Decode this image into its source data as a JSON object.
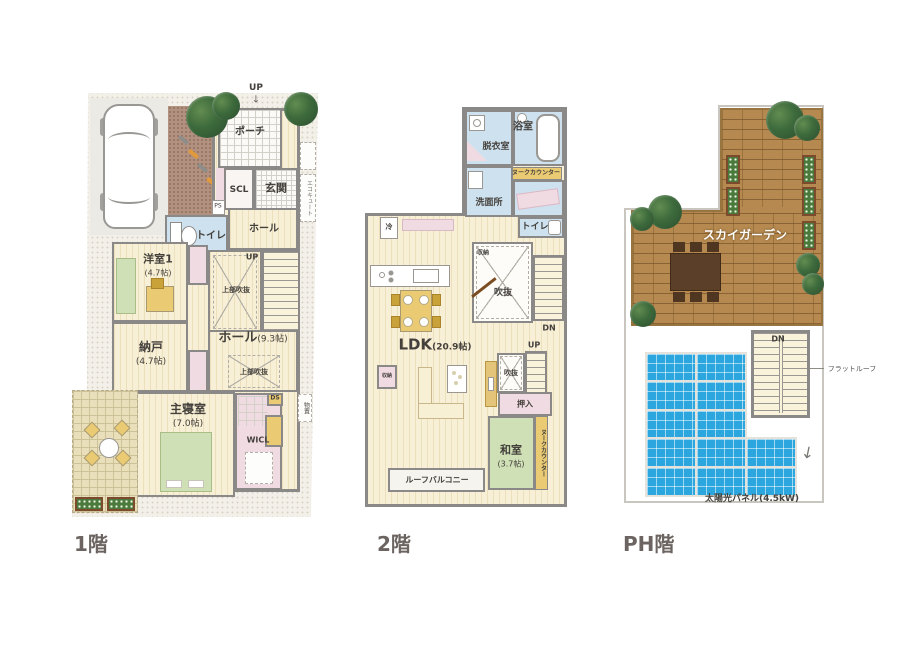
{
  "colors": {
    "wall": "#8b8987",
    "wood_floor": "#f8f0d6",
    "water_blue": "#cde1ee",
    "closet_pink": "#f1dbe3",
    "tatami_green": "#cfe0b6",
    "accent_yellow": "#eaca72",
    "deck_brown": "#b5894f",
    "solar_blue": "#2ba6df",
    "caption_gray": "#6b6460"
  },
  "floors": {
    "f1": {
      "caption": "1階",
      "up_top": "UP",
      "up_arrow": "↓",
      "porch": "ポーチ",
      "scl": "SCL",
      "genkan": "玄関",
      "ps": "PS",
      "toilet": "トイレ",
      "hall1": "ホール",
      "up_stairs": "UP",
      "void_upper1": "上部吹抜",
      "yoshitsu": "洋室1",
      "yoshitsu_size": "(4.7帖)",
      "nando": "納戸",
      "nando_size": "(4.7帖)",
      "hall_main": "ホール",
      "hall_main_size": "(9.3帖)",
      "void_upper2": "上部吹抜",
      "shushinshitsu": "主寝室",
      "shushinshitsu_size": "(7.0帖)",
      "wicl": "WICL",
      "ds": "DS",
      "ecocute": "エコキュート",
      "storage_out": "物置"
    },
    "f2": {
      "caption": "2階",
      "datsuishitsu": "脱衣室",
      "yokushitsu": "浴室",
      "nook_counter_top": "ヌークカウンター",
      "senmenjo": "洗面所",
      "toilet": "トイレ",
      "fridge": "冷",
      "shuno_top": "収納",
      "fukinuke1": "吹抜",
      "dn": "DN",
      "ldk": "LDK",
      "ldk_size": "(20.9帖)",
      "up": "UP",
      "fukinuke2": "吹抜",
      "shuno_left": "収納",
      "oshiire": "押入",
      "washitsu": "和室",
      "washitsu_size": "(3.7帖)",
      "nook_counter_side": "ヌークカウンター",
      "roof_balcony": "ルーフバルコニー"
    },
    "ph": {
      "caption": "PH階",
      "sky_garden": "スカイガーデン",
      "dn": "DN",
      "flat_roof": "フラットルーフ",
      "solar_label": "太陽光パネル(4.5kW)",
      "solar": {
        "rows": [
          2,
          2,
          2,
          3,
          3
        ]
      }
    }
  }
}
